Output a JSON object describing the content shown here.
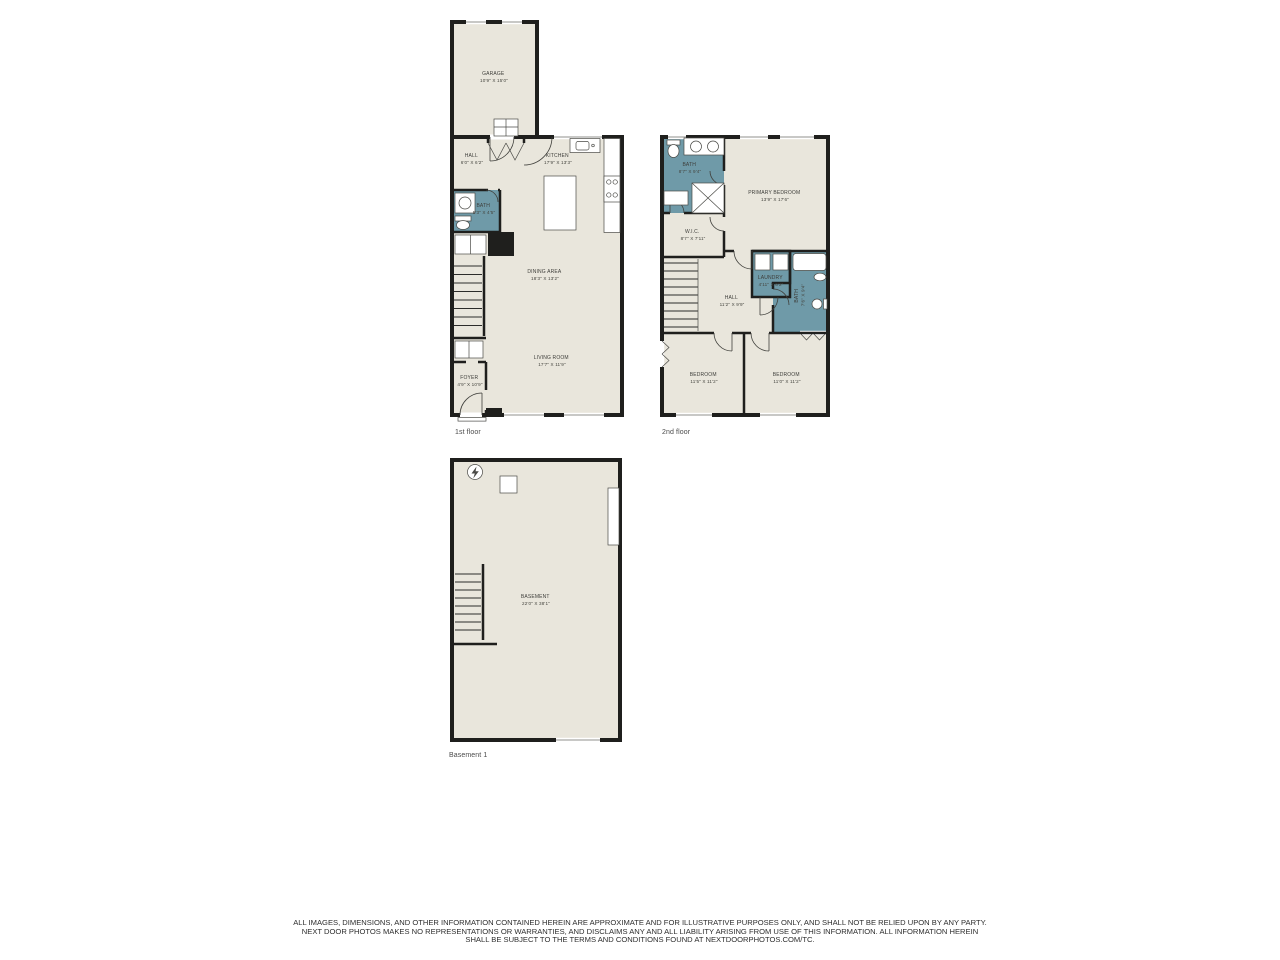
{
  "palette": {
    "background": "#ffffff",
    "wall": "#1f1f1d",
    "room_fill": "#e9e6dc",
    "wet_room_fill": "#6f9aa8",
    "label_text": "#3e3e3a",
    "floor_label_text": "#4b4b4b",
    "disclaimer_text": "#2e2e2e"
  },
  "floors": {
    "first": {
      "label": "1st floor",
      "rooms": {
        "garage": {
          "name": "GARAGE",
          "dims": "10'9\" X 15'0\""
        },
        "hall": {
          "name": "HALL",
          "dims": "6'0\" X 6'2\""
        },
        "kitchen": {
          "name": "KITCHEN",
          "dims": "17'9\" X 13'3\""
        },
        "bath": {
          "name": "BATH",
          "dims": "5'3\" X 4'5\""
        },
        "dining": {
          "name": "DINING AREA",
          "dims": "18'3\" X 13'2\""
        },
        "living": {
          "name": "LIVING ROOM",
          "dims": "17'7\" X 11'9\""
        },
        "foyer": {
          "name": "FOYER",
          "dims": "4'9\" X 10'9\""
        }
      }
    },
    "second": {
      "label": "2nd floor",
      "rooms": {
        "bath": {
          "name": "BATH",
          "dims": "8'7\" X 9'4\""
        },
        "primary": {
          "name": "PRIMARY BEDROOM",
          "dims": "13'9\" X 17'6\""
        },
        "wic": {
          "name": "W.I.C.",
          "dims": "8'7\" X 7'11\""
        },
        "laundry": {
          "name": "LAUNDRY",
          "dims": "4'11\" X 6'2\""
        },
        "bath2": {
          "name": "BATH",
          "dims": "7'6\" X 9'4\""
        },
        "hall": {
          "name": "HALL",
          "dims": "11'2\" X 9'9\""
        },
        "bedroom1": {
          "name": "BEDROOM",
          "dims": "11'5\" X 11'2\""
        },
        "bedroom2": {
          "name": "BEDROOM",
          "dims": "11'0\" X 11'2\""
        }
      }
    },
    "basement": {
      "label": "Basement 1",
      "rooms": {
        "basement": {
          "name": "BASEMENT",
          "dims": "22'0\" X 38'1\""
        }
      }
    }
  },
  "disclaimer": {
    "line1": "ALL IMAGES, DIMENSIONS, AND OTHER INFORMATION CONTAINED HEREIN ARE APPROXIMATE AND FOR ILLUSTRATIVE PURPOSES ONLY, AND SHALL NOT BE RELIED UPON BY ANY PARTY.",
    "line2": "NEXT DOOR PHOTOS MAKES NO REPRESENTATIONS OR WARRANTIES, AND DISCLAIMS ANY AND ALL LIABILITY ARISING FROM USE OF THIS INFORMATION. ALL INFORMATION HEREIN",
    "line3": "SHALL BE SUBJECT TO THE TERMS AND CONDITIONS FOUND AT NEXTDOORPHOTOS.COM/TC."
  }
}
